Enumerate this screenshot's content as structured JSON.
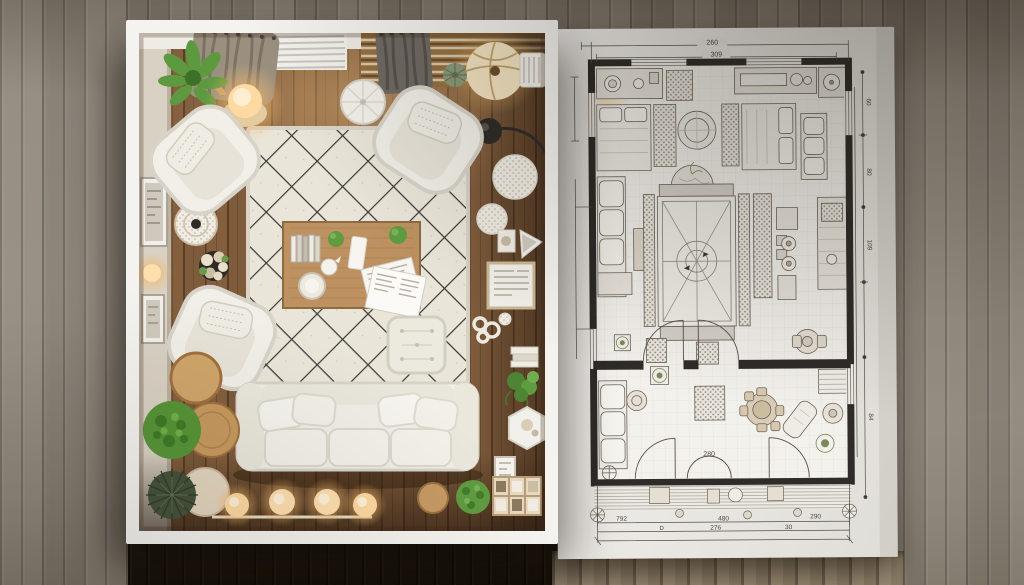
{
  "scene": {
    "left_panel": "living-room-top-view-photo",
    "right_panel": "living-room-floor-plan-sheet"
  },
  "floor_plan": {
    "dim_top": [
      "260",
      "309"
    ],
    "dim_bottom_row1": [
      "792",
      "480",
      "290"
    ],
    "dim_bottom_row2": [
      "D",
      "276",
      "30"
    ],
    "dim_right": [
      "60",
      "80",
      "109",
      "84"
    ],
    "door_label": "280"
  },
  "palette": {
    "wall_panels": "#8d8579",
    "photo_frame": "#f4f3ef",
    "wood_floor": "#7d5b3b",
    "rug": "#e9e5d9",
    "rug_lattice": "#3c3a35",
    "sofa": "#f0eee7",
    "coffee_table": "#bd9160",
    "plant_green": "#569537",
    "lamp_glow": "#ffd9a2",
    "paper": "#eceae5",
    "plan_wall": "#2e2b28",
    "dark_floor_shadow": "#1c1713"
  }
}
